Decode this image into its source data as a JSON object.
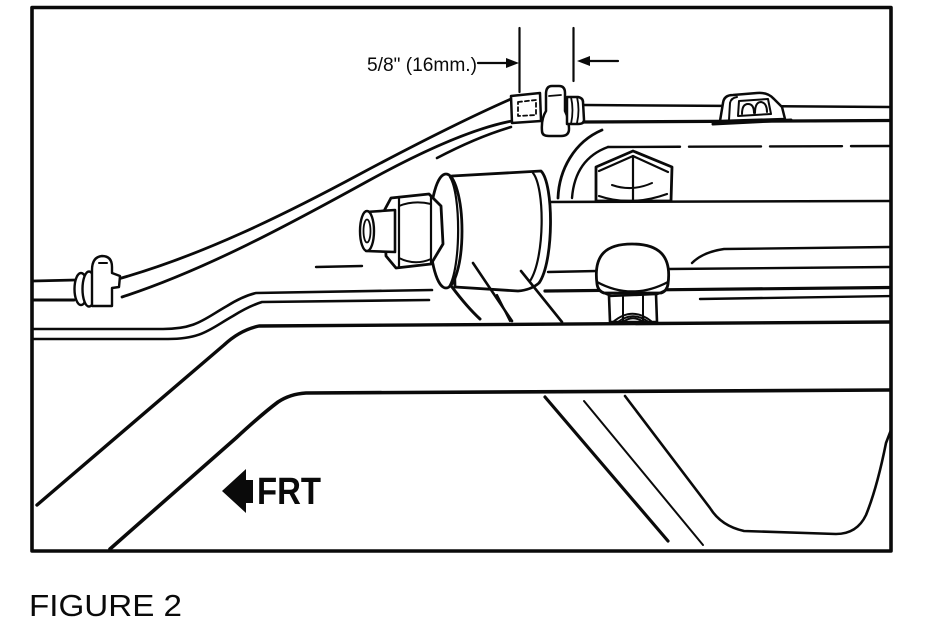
{
  "palette": {
    "paper": "#ffffff",
    "ink": "#0a0a0a"
  },
  "figure": {
    "caption": "FIGURE 2",
    "dimension_label": "5/8\" (16mm.)",
    "direction_label": "FRT"
  },
  "icons": {
    "frt_arrow": "solid-left-arrow",
    "dimension_arrow_right": "right-arrowhead",
    "dimension_arrow_left": "left-arrowhead"
  }
}
